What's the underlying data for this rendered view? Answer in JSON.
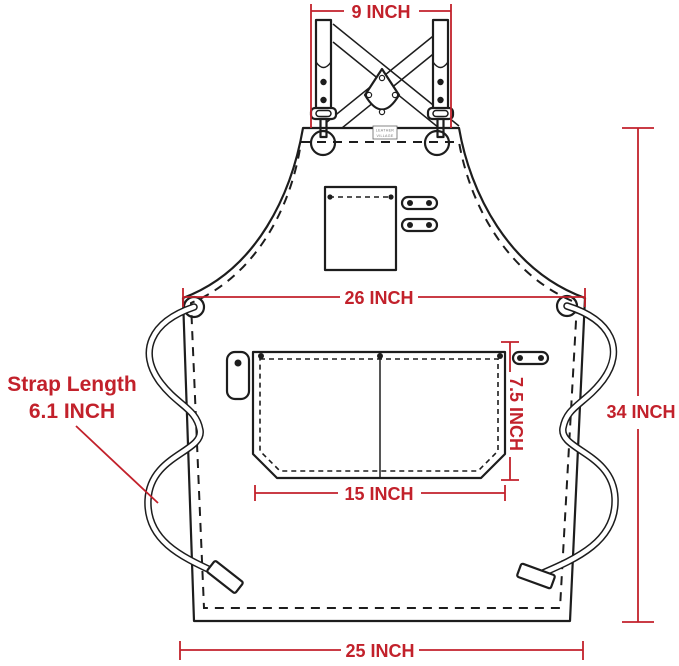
{
  "title": "Apron dimension diagram",
  "colors": {
    "dimension_red": "#C2212B",
    "line_black": "#1d1d1d",
    "background": "#ffffff"
  },
  "brand_label": {
    "line1": "LEATHER",
    "line2": "VILLAGE"
  },
  "dimensions": {
    "top_strap_width": "9 INCH",
    "chest_width": "26 INCH",
    "body_height": "34 INCH",
    "bottom_width": "25 INCH",
    "pocket_width": "15 INCH",
    "pocket_height": "7.5 INCH",
    "strap_length_label": "Strap Length",
    "strap_length_value": "6.1 INCH"
  }
}
